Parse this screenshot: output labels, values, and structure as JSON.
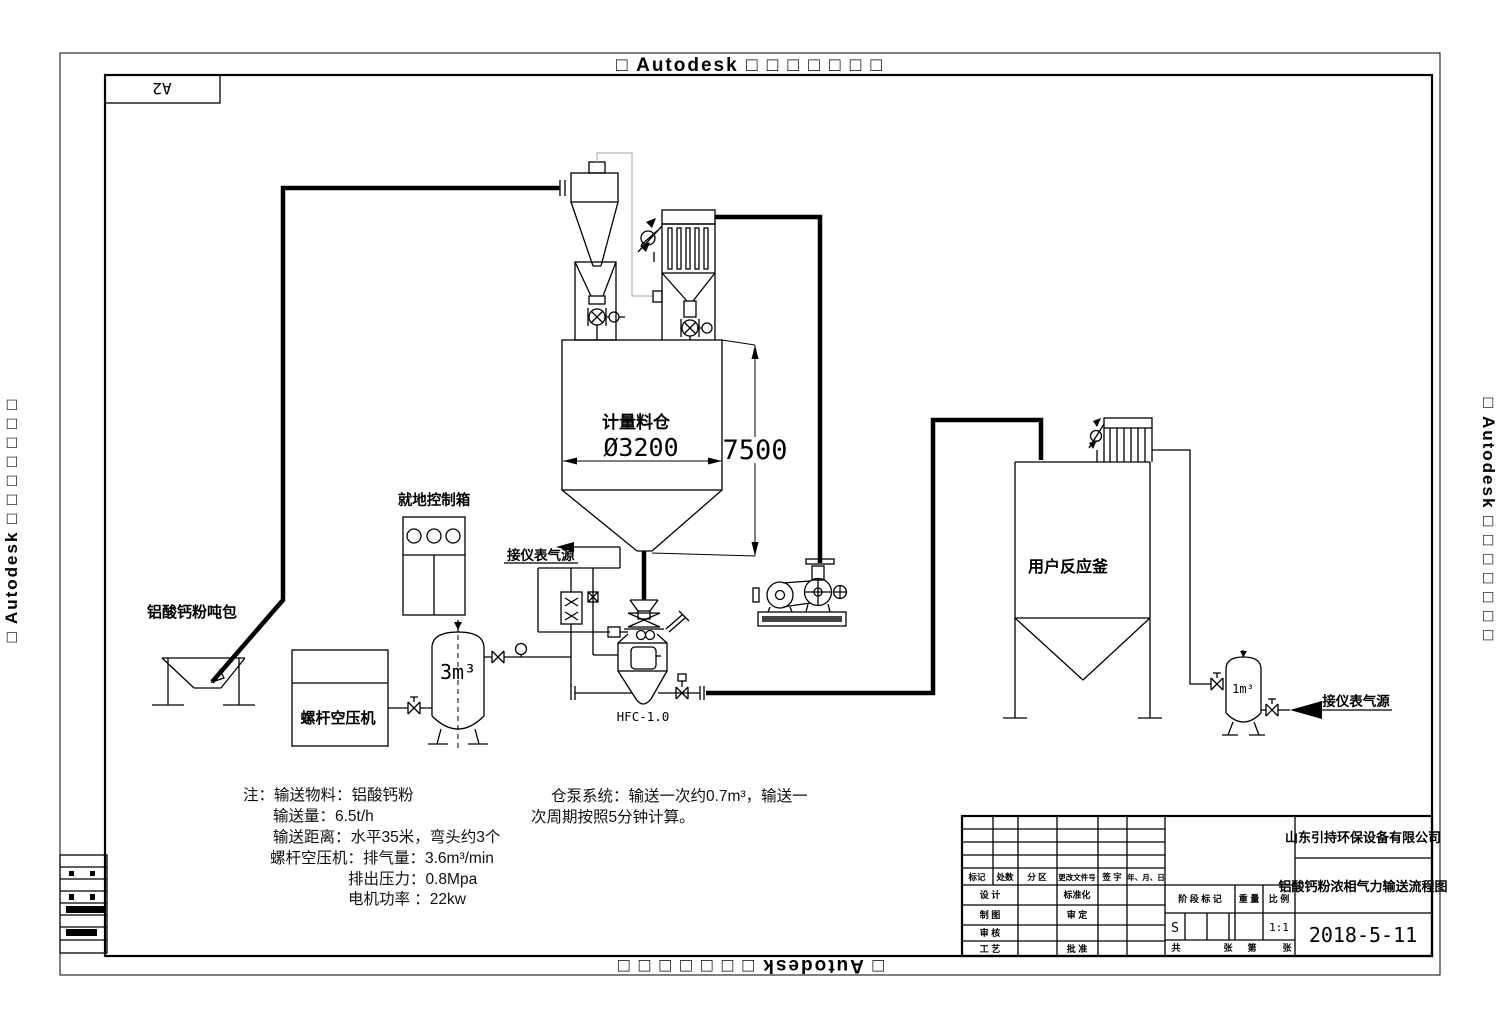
{
  "watermark": {
    "top": "□ Autodesk □ □ □ □ □ □ □",
    "bottom": "□ Autodesk □ □ □ □ □ □ □",
    "left": "□ Autodesk □ □ □ □ □ □ □",
    "right": "□ Autodesk □ □ □ □ □ □ □"
  },
  "sheet_label": "A2",
  "labels": {
    "ton_bag": "铝酸钙粉吨包",
    "control_box": "就地控制箱",
    "compressor": "螺杆空压机",
    "air_tank": "3m³",
    "silo_name": "计量料仓",
    "silo_diameter": "Ø3200",
    "silo_height": "7500",
    "pump_model": "HFC-1.0",
    "reactor": "用户反应釜",
    "small_tank": "1m³",
    "instrument_air_left": "接仪表气源",
    "instrument_air_right": "接仪表气源"
  },
  "notes": {
    "lines": [
      "注：输送物料：铝酸钙粉",
      "输送量：6.5t/h",
      "输送距离：水平35米，弯头约3个",
      "螺杆空压机：排气量：3.6m³/min",
      "排出压力：0.8Mpa",
      "电机功率 ：22kw"
    ]
  },
  "pump_note": {
    "line1": "仓泵系统：输送一次约0.7m³，输送一",
    "line2": "次周期按照5分钟计算。"
  },
  "title_block": {
    "company": "山东引持环保设备有限公司",
    "drawing_title": "铝酸钙粉浓相气力输送流程图",
    "date": "2018-5-11",
    "header": {
      "mark": "标记",
      "count": "处数",
      "zone": "分 区",
      "doc_no": "更改文件号",
      "sign": "签 字",
      "ymd": "年、月、日"
    },
    "roles": {
      "design": "设 计",
      "draft": "制 图",
      "review": "审 核",
      "process": "工 艺",
      "standardize": "标准化",
      "approve": "审 定",
      "ratify": "批 准"
    },
    "stage": {
      "header": "阶 段 标 记",
      "weight": "重 量",
      "scale": "比 例",
      "stage_value": "S",
      "scale_value": "1:1"
    },
    "pages": {
      "total": "共",
      "sheet_a": "张",
      "page": "第",
      "sheet_b": "张"
    }
  }
}
